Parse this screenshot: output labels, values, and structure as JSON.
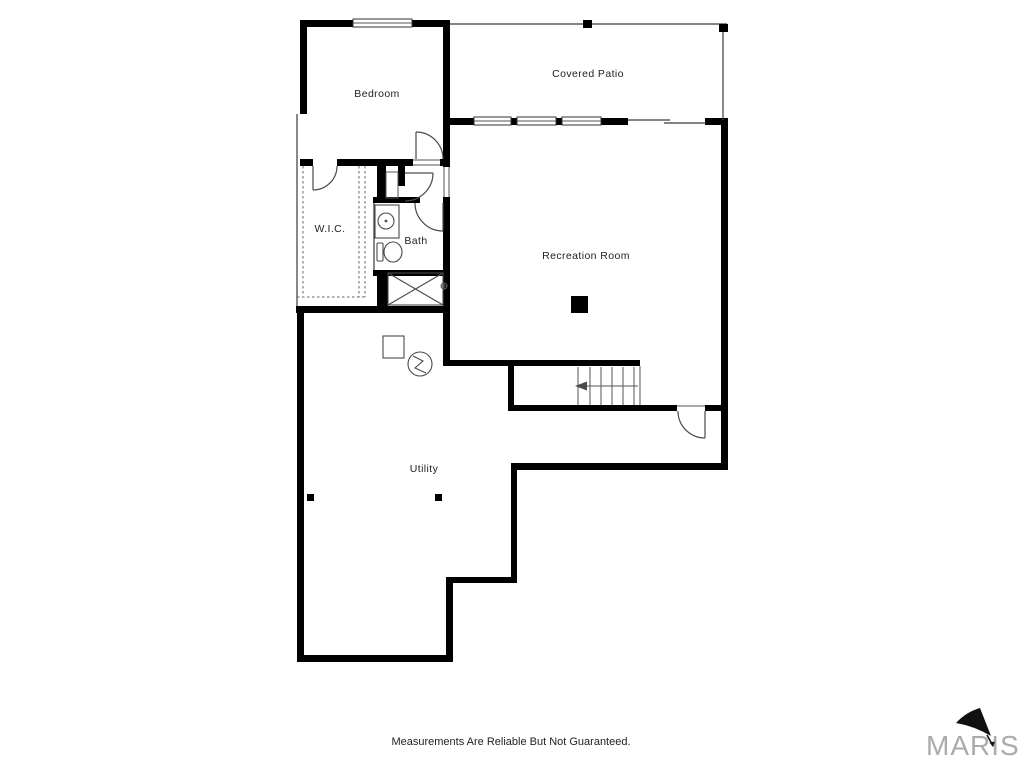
{
  "plan": {
    "type": "floor-plan",
    "rooms": [
      {
        "name": "bedroom",
        "label": "Bedroom"
      },
      {
        "name": "covered_patio",
        "label": "Covered Patio"
      },
      {
        "name": "wic",
        "label": "W.I.C."
      },
      {
        "name": "bath",
        "label": "Bath"
      },
      {
        "name": "recreation_room",
        "label": "Recreation Room"
      },
      {
        "name": "utility",
        "label": "Utility"
      }
    ],
    "features": [
      "stairs-up-arrow",
      "sink",
      "toilet",
      "water-heater",
      "furnace",
      "x-hatched-area",
      "support-columns",
      "door-swings",
      "windows",
      "sliding-door"
    ]
  },
  "footer": {
    "disclaimer": "Measurements Are Reliable But Not Guaranteed."
  },
  "branding": {
    "logo_text": "MARIS"
  },
  "colors": {
    "wall": "#000000",
    "line": "#444444",
    "label": "#222222",
    "logo": "#ababab",
    "background": "#ffffff"
  }
}
